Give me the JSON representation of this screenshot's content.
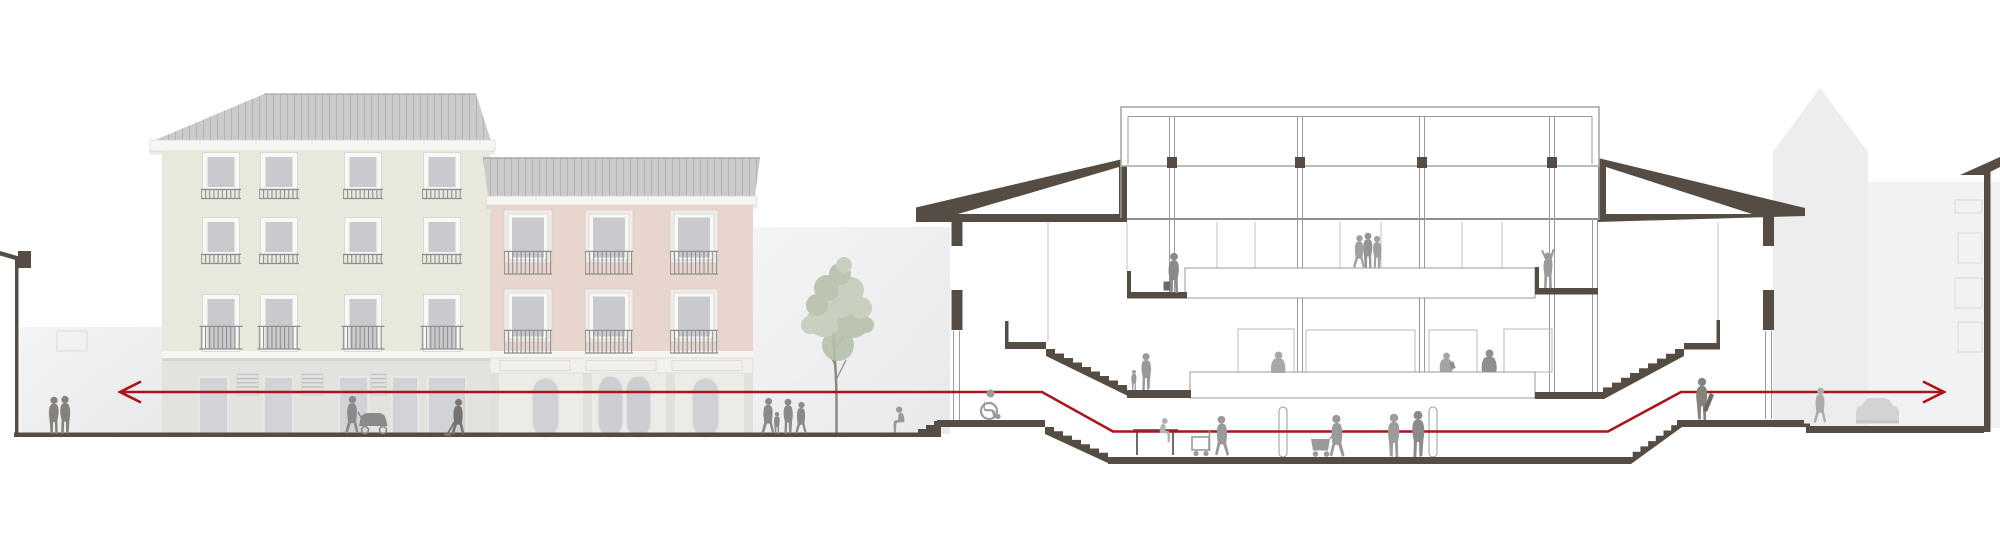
{
  "meta": {
    "kind": "architectural street elevation and building cross-section drawing",
    "canvas": {
      "width": 2000,
      "height": 535
    },
    "text_visible": "none"
  },
  "colors": {
    "poche": "#554c43",
    "line": "#9a9a9a",
    "line_light": "#c2c2c2",
    "red": "#a8151a",
    "backdrop": "#ededef",
    "backdrop2": "#f2f2f4",
    "green_facade": "#e9e8dc",
    "pink_facade": "#e8d6ce",
    "roof": "#cbcbcb",
    "roof_seam": "#b3b3b3",
    "cornice": "#f6f6f2",
    "glass": "#c9cacd",
    "shop_grey": "#e3e2df",
    "shop_door": "#d2d3d6",
    "pink_shop": "#edebe8",
    "pink_opening": "#d0d1d4",
    "people": "#9a9a9a",
    "people_dark": "#85817b",
    "people_light": "#b2b2b2",
    "foliage": "#b7c1ab",
    "foliage_light": "#c6cdba",
    "trunk": "#8e8c82",
    "paper": "#ffffff"
  },
  "scene": {
    "left_elevation": {
      "buildings": [
        {
          "name": "green-tenement",
          "facade_color_key": "green_facade",
          "window_floors": 3,
          "ground_floor": "shopfront with doors",
          "roof": "hipped standing-seam metal"
        },
        {
          "name": "pink-tenement",
          "facade_color_key": "pink_facade",
          "window_floors": 2,
          "ground_floor": "ornate arched shopfront",
          "roof": "standing-seam metal"
        }
      ],
      "street_lamp": 1,
      "tree": 1
    },
    "section_building": {
      "type": "public hall cut in section",
      "roof": "butterfly wedges with central clerestory",
      "levels": [
        "entry landing",
        "lower hall floor",
        "middle tier",
        "upper tier"
      ],
      "stairs": 4
    },
    "right_context": [
      "tower silhouette",
      "neighbour facade cut at edge",
      "street furniture / vehicle"
    ],
    "accessible_route": {
      "color_key": "red",
      "arrows": [
        "left",
        "right"
      ],
      "shape": "horizontal datum stepping with stairs"
    }
  },
  "figures": [
    "two-women-left",
    "woman-with-pram",
    "street-sweeper",
    "family-group",
    "person-sitting-on-steps",
    "wheelchair-user",
    "mother-and-child",
    "man-with-briefcase",
    "group-upper-tier",
    "person-arms-raised",
    "person-middle-tier",
    "seated-reader",
    "person-small-middle-tier",
    "person-with-trolley",
    "two-people-talking",
    "person-with-cart",
    "person-on-bench",
    "person-right-landing",
    "person-right-street"
  ]
}
